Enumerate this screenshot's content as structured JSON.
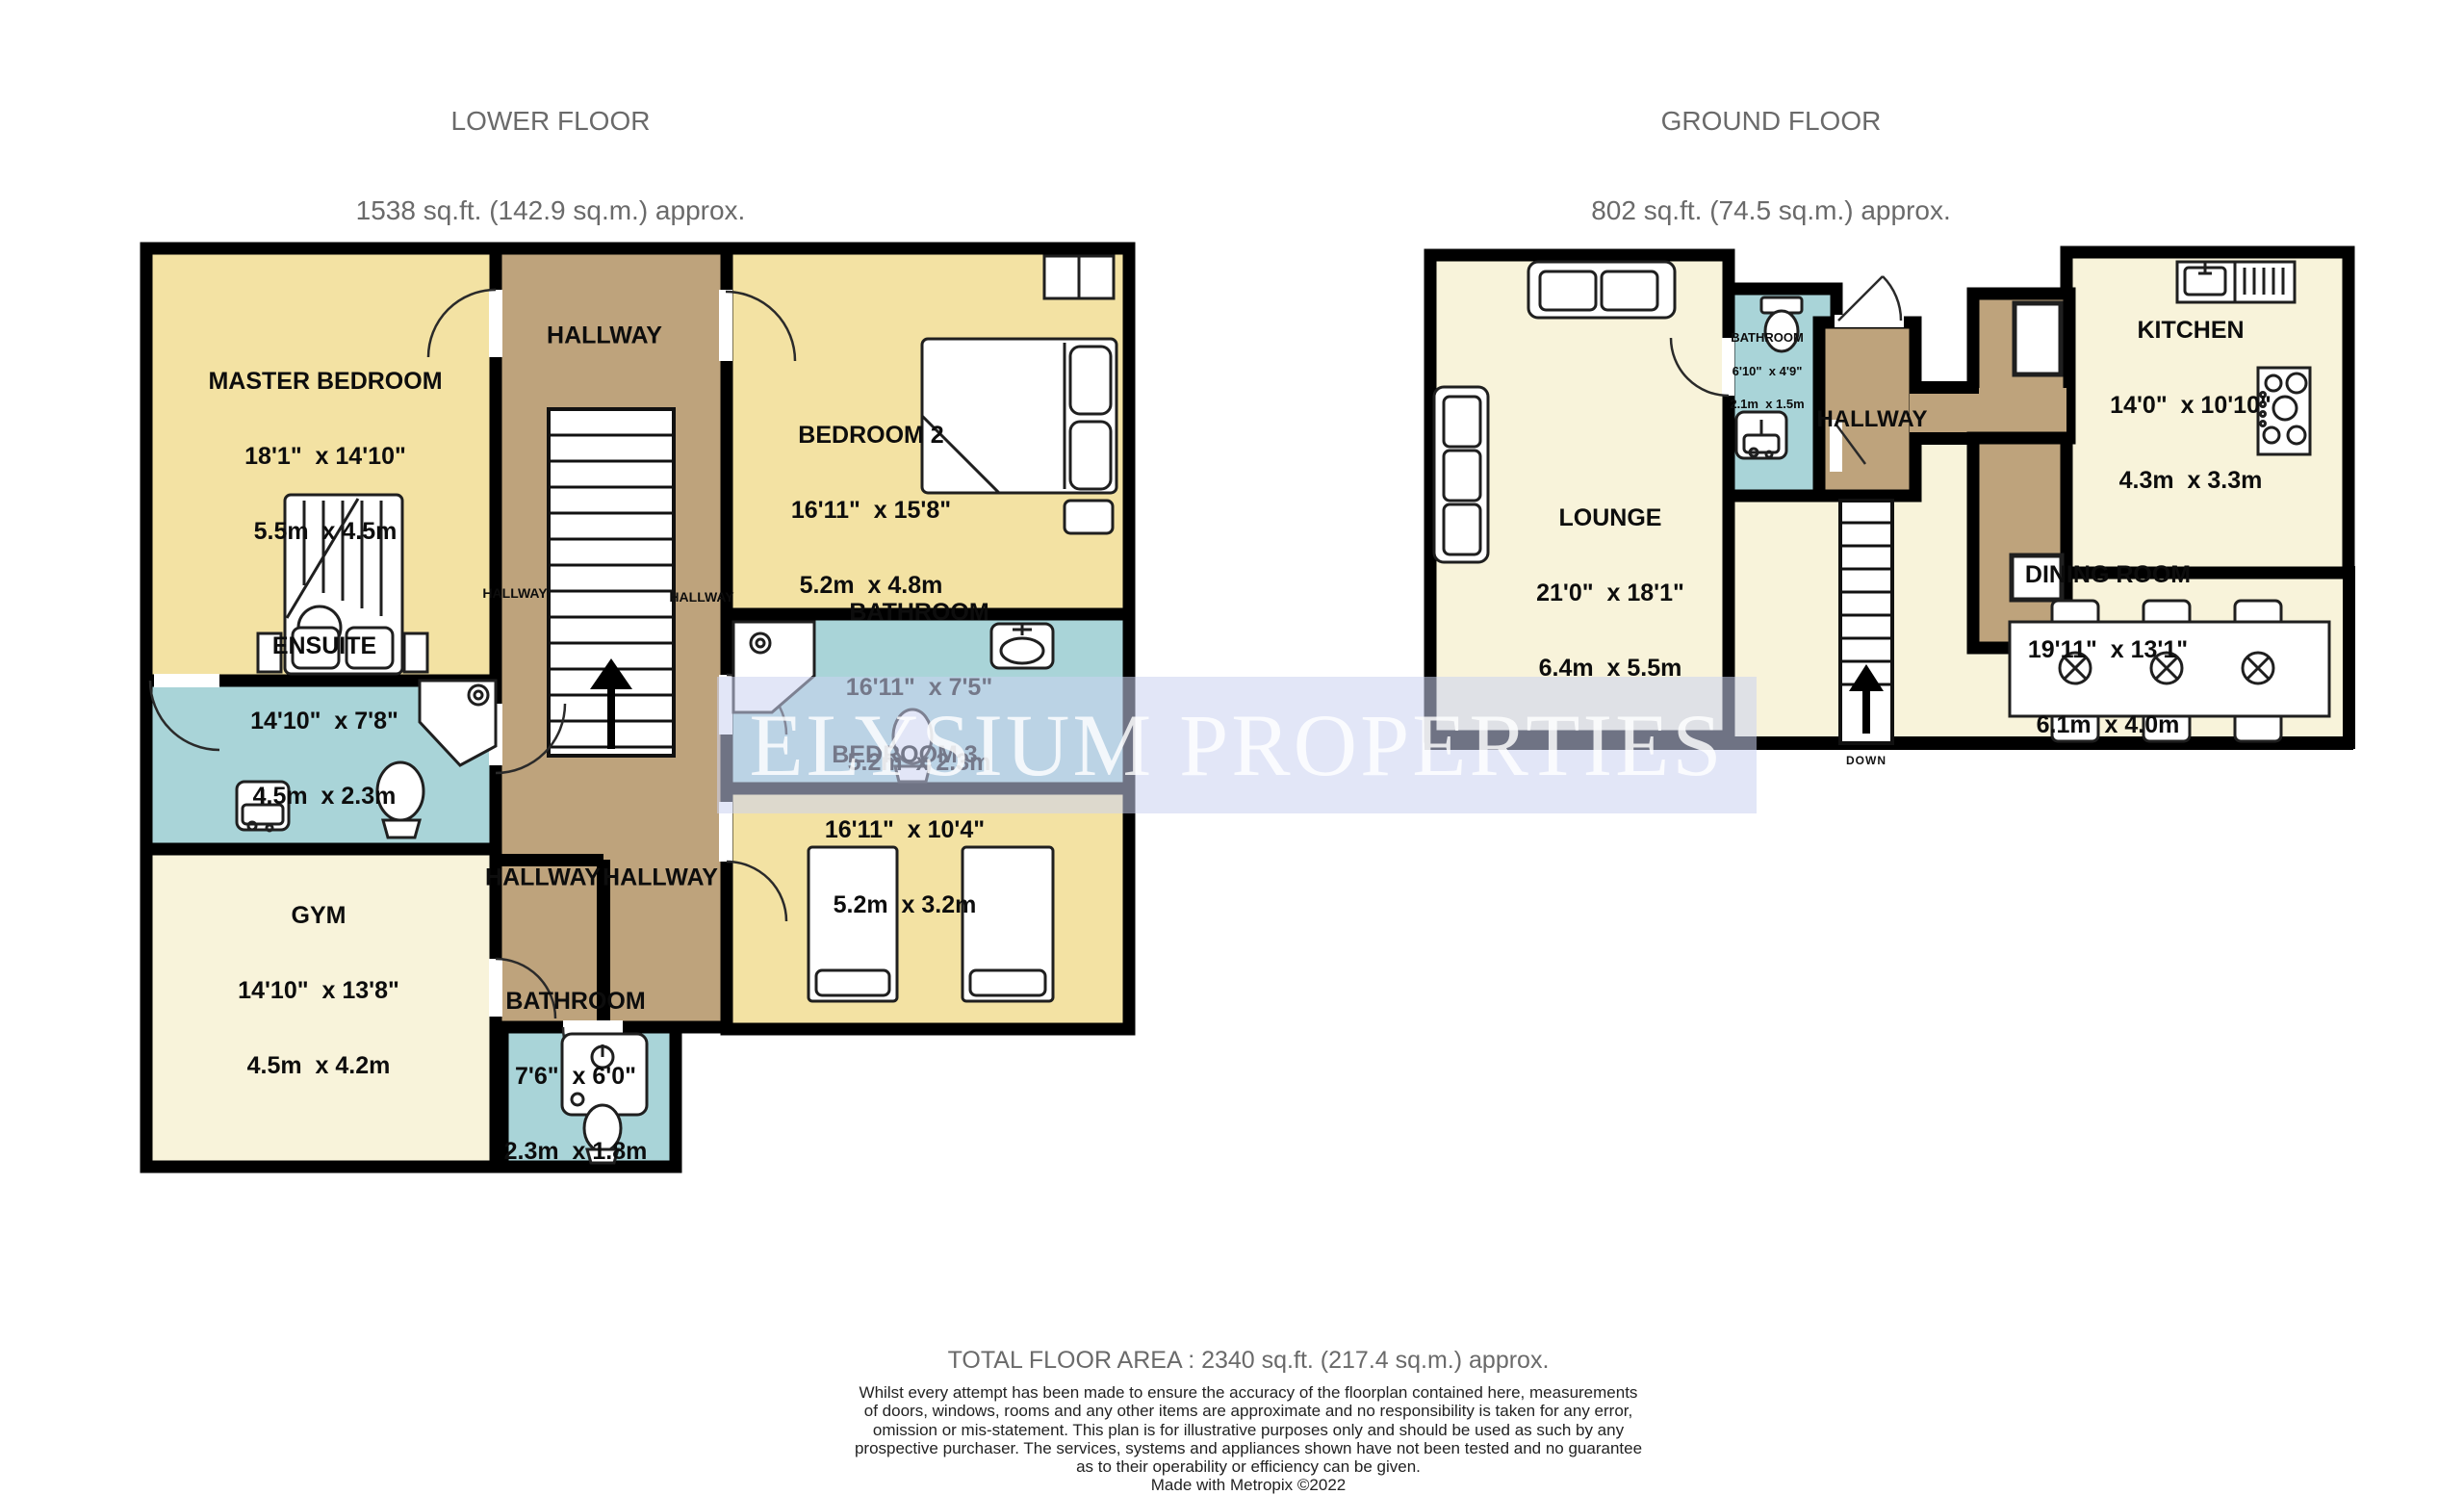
{
  "floors": {
    "lower": {
      "title": "LOWER FLOOR",
      "area": "1538 sq.ft. (142.9 sq.m.) approx.",
      "rooms": {
        "master_bedroom": {
          "name": "MASTER BEDROOM",
          "imperial": "18'1\"  x 14'10\"",
          "metric": "5.5m  x 4.5m"
        },
        "bedroom2": {
          "name": "BEDROOM 2",
          "imperial": "16'11\"  x 15'8\"",
          "metric": "5.2m  x 4.8m"
        },
        "bathroom": {
          "name": "BATHROOM",
          "imperial": "16'11\"  x 7'5\"",
          "metric": "5.2m  x 2.3m"
        },
        "bedroom3": {
          "name": "BEDROOM 3",
          "imperial": "16'11\"  x 10'4\"",
          "metric": "5.2m  x 3.2m"
        },
        "ensuite": {
          "name": "ENSUITE",
          "imperial": "14'10\"  x 7'8\"",
          "metric": "4.5m  x 2.3m"
        },
        "gym": {
          "name": "GYM",
          "imperial": "14'10\"  x 13'8\"",
          "metric": "4.5m  x 4.2m"
        },
        "bathroom_small": {
          "name": "BATHROOM",
          "imperial": "7'6\"  x 6'0\"",
          "metric": "2.3m  x 1.8m"
        },
        "hallway": {
          "name": "HALLWAY"
        }
      }
    },
    "ground": {
      "title": "GROUND FLOOR",
      "area": "802 sq.ft. (74.5 sq.m.) approx.",
      "rooms": {
        "lounge": {
          "name": "LOUNGE",
          "imperial": "21'0\"  x 18'1\"",
          "metric": "6.4m  x 5.5m"
        },
        "bathroom": {
          "name": "BATHROOM",
          "imperial": "6'10\"  x 4'9\"",
          "metric": "2.1m  x 1.5m"
        },
        "hallway": {
          "name": "HALLWAY"
        },
        "kitchen": {
          "name": "KITCHEN",
          "imperial": "14'0\"  x 10'10\"",
          "metric": "4.3m  x 3.3m"
        },
        "dining": {
          "name": "DINING ROOM",
          "imperial": "19'11\"  x 13'1\"",
          "metric": "6.1m  x 4.0m"
        },
        "stairs_label": "DOWN"
      }
    }
  },
  "watermark": "ELYSIUM PROPERTIES",
  "footer": {
    "total": "TOTAL FLOOR AREA : 2340 sq.ft. (217.4 sq.m.) approx.",
    "disclaimer_lines": [
      "Whilst every attempt has been made to ensure the accuracy of the floorplan contained here, measurements",
      "of doors, windows, rooms and any other items are approximate and no responsibility is taken for any error,",
      "omission or mis-statement. This plan is for illustrative purposes only and should be used as such by any",
      "prospective purchaser. The services, systems and appliances shown have not been tested and no guarantee",
      "as to their operability or efficiency can be given."
    ],
    "credit": "Made with Metropix ©2022"
  },
  "colors": {
    "wall": "#000000",
    "room_yellow": "#f3e2a3",
    "room_cream": "#f8f3da",
    "room_blue": "#a9d4d8",
    "hallway_brown": "#bea37c",
    "title_gray": "#6a6a6a",
    "watermark_band": "rgba(202,210,241,0.55)",
    "watermark_text": "rgba(255,255,255,0.82)"
  }
}
